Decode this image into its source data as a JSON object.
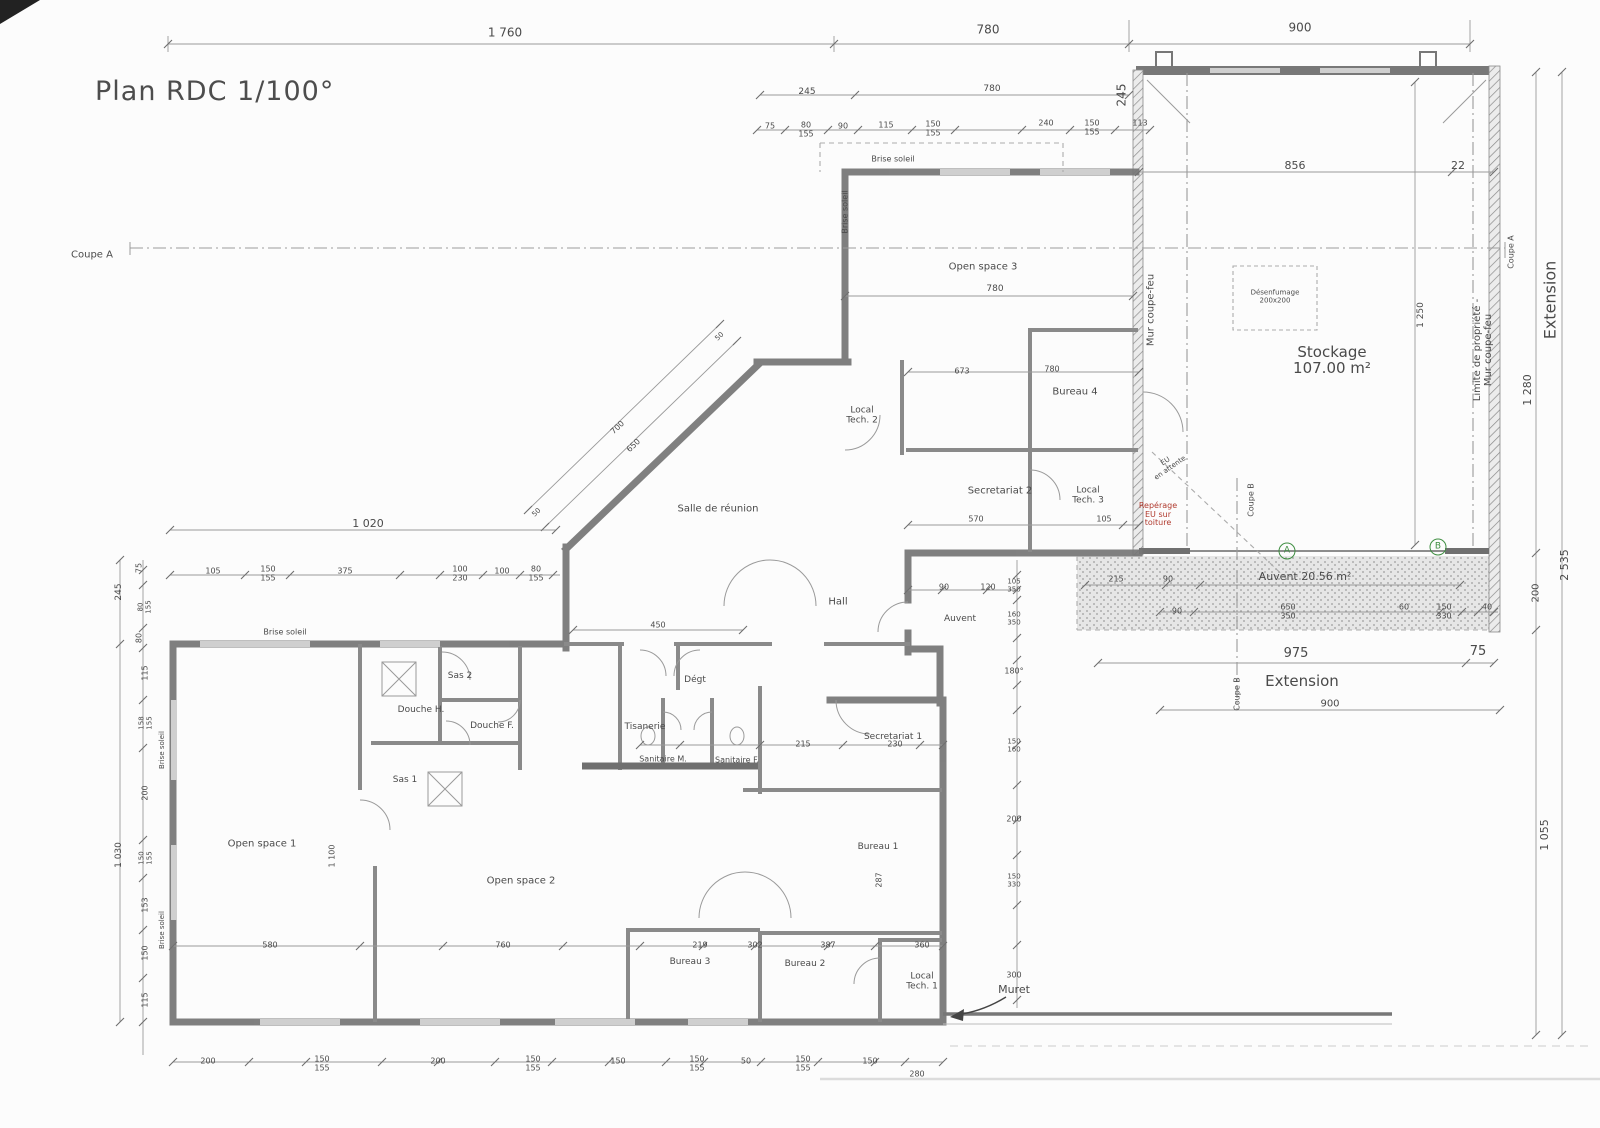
{
  "title": "Plan RDC 1/100°",
  "colors": {
    "annotation_red": "#b03a2e",
    "marker_green": "#3e8e41",
    "line_gray": "#9a9a9a",
    "wall_gray": "#757575"
  },
  "labels": [
    {
      "t": "Coupe A",
      "x": 92,
      "y": 256,
      "s": 10,
      "n": "section-a-label"
    },
    {
      "t": "1 760",
      "x": 505,
      "y": 33,
      "s": 12
    },
    {
      "t": "780",
      "x": 988,
      "y": 30,
      "s": 12
    },
    {
      "t": "900",
      "x": 1300,
      "y": 28,
      "s": 12
    },
    {
      "t": "245",
      "x": 807,
      "y": 93,
      "s": 9
    },
    {
      "t": "780",
      "x": 992,
      "y": 90,
      "s": 9
    },
    {
      "t": "245",
      "x": 1122,
      "y": 95,
      "s": 12,
      "r": -90
    },
    {
      "t": "75",
      "x": 770,
      "y": 127,
      "s": 8
    },
    {
      "t": "80\n155",
      "x": 806,
      "y": 130,
      "s": 8
    },
    {
      "t": "90",
      "x": 843,
      "y": 127,
      "s": 8
    },
    {
      "t": "115",
      "x": 886,
      "y": 126,
      "s": 8
    },
    {
      "t": "150\n155",
      "x": 933,
      "y": 129,
      "s": 8
    },
    {
      "t": "240",
      "x": 1046,
      "y": 124,
      "s": 8
    },
    {
      "t": "150\n155",
      "x": 1092,
      "y": 128,
      "s": 8
    },
    {
      "t": "113",
      "x": 1140,
      "y": 124,
      "s": 8
    },
    {
      "t": "Brise soleil",
      "x": 893,
      "y": 160,
      "s": 8,
      "n": "brise-soleil-label"
    },
    {
      "t": "Brise soleil",
      "x": 846,
      "y": 212,
      "s": 8,
      "r": -90,
      "n": "brise-soleil-label"
    },
    {
      "t": "856",
      "x": 1295,
      "y": 166,
      "s": 11
    },
    {
      "t": "22",
      "x": 1458,
      "y": 166,
      "s": 11
    },
    {
      "t": "Open space 3",
      "x": 983,
      "y": 268,
      "s": 10,
      "n": "room-label-open-space-3"
    },
    {
      "t": "780",
      "x": 995,
      "y": 290,
      "s": 9
    },
    {
      "t": "Bureau 4",
      "x": 1075,
      "y": 393,
      "s": 10,
      "n": "room-label-bureau-4"
    },
    {
      "t": "673",
      "x": 962,
      "y": 372,
      "s": 8
    },
    {
      "t": "780",
      "x": 1052,
      "y": 370,
      "s": 8
    },
    {
      "t": "Local\nTech. 2",
      "x": 862,
      "y": 416,
      "s": 9,
      "n": "room-label-local-tech-2"
    },
    {
      "t": "Secretariat 2",
      "x": 1000,
      "y": 492,
      "s": 10,
      "n": "room-label-secretariat-2"
    },
    {
      "t": "Local\nTech. 3",
      "x": 1088,
      "y": 496,
      "s": 9,
      "n": "room-label-local-tech-3"
    },
    {
      "t": "570",
      "x": 976,
      "y": 520,
      "s": 8
    },
    {
      "t": "105",
      "x": 1104,
      "y": 520,
      "s": 8
    },
    {
      "t": "Stockage\n107.00 m²",
      "x": 1332,
      "y": 360,
      "s": 15,
      "n": "room-label-stockage"
    },
    {
      "t": "Désenfumage\n200x200",
      "x": 1275,
      "y": 297,
      "s": 7,
      "n": "smoke-vent-label"
    },
    {
      "t": "1 250",
      "x": 1422,
      "y": 315,
      "s": 9,
      "r": -90
    },
    {
      "t": "Mur coupe-feu",
      "x": 1152,
      "y": 310,
      "s": 10,
      "r": -90,
      "n": "firewall-label"
    },
    {
      "t": "Limite de propriété - Mur coupe-feu",
      "x": 1484,
      "y": 350,
      "s": 10,
      "r": -90,
      "n": "property-limit-label"
    },
    {
      "t": "Coupe A",
      "x": 1512,
      "y": 252,
      "s": 8,
      "r": -90,
      "n": "section-a-label"
    },
    {
      "t": "Extension",
      "x": 1550,
      "y": 300,
      "s": 16,
      "r": -90,
      "n": "extension-label"
    },
    {
      "t": "1 280",
      "x": 1528,
      "y": 390,
      "s": 11,
      "r": -90
    },
    {
      "t": "2 535",
      "x": 1565,
      "y": 565,
      "s": 11,
      "r": -90
    },
    {
      "t": "200",
      "x": 1537,
      "y": 593,
      "s": 10,
      "r": -90
    },
    {
      "t": "1 055",
      "x": 1545,
      "y": 835,
      "s": 11,
      "r": -90
    },
    {
      "t": "EU\nen attente",
      "x": 1168,
      "y": 465,
      "s": 7,
      "r": -35,
      "n": "eu-attente-note"
    },
    {
      "t": "Repérage\nEU sur\ntoiture",
      "x": 1158,
      "y": 515,
      "s": 8,
      "c": "red",
      "n": "red-annotation"
    },
    {
      "t": "Coupe B",
      "x": 1252,
      "y": 500,
      "s": 8,
      "r": -90,
      "n": "section-b-label"
    },
    {
      "t": "Coupe B",
      "x": 1238,
      "y": 694,
      "s": 8,
      "r": -90,
      "n": "section-b-label"
    },
    {
      "t": "A",
      "x": 1287,
      "y": 551,
      "s": 9,
      "circle": true,
      "n": "marker-a"
    },
    {
      "t": "B",
      "x": 1438,
      "y": 547,
      "s": 9,
      "circle": true,
      "n": "marker-b"
    },
    {
      "t": "Auvent 20.56 m²",
      "x": 1305,
      "y": 577,
      "s": 11,
      "n": "room-label-auvent"
    },
    {
      "t": "215",
      "x": 1116,
      "y": 580,
      "s": 8
    },
    {
      "t": "90",
      "x": 1168,
      "y": 580,
      "s": 8
    },
    {
      "t": "90",
      "x": 1177,
      "y": 612,
      "s": 8
    },
    {
      "t": "650\n350",
      "x": 1288,
      "y": 612,
      "s": 8
    },
    {
      "t": "60",
      "x": 1404,
      "y": 608,
      "s": 8
    },
    {
      "t": "150\n330",
      "x": 1444,
      "y": 612,
      "s": 8
    },
    {
      "t": "40",
      "x": 1487,
      "y": 608,
      "s": 8
    },
    {
      "t": "975",
      "x": 1296,
      "y": 654,
      "s": 13
    },
    {
      "t": "75",
      "x": 1478,
      "y": 652,
      "s": 13
    },
    {
      "t": "Extension",
      "x": 1302,
      "y": 681,
      "s": 15,
      "n": "extension-label"
    },
    {
      "t": "900",
      "x": 1330,
      "y": 705,
      "s": 10
    },
    {
      "t": "Salle de réunion",
      "x": 718,
      "y": 510,
      "s": 10,
      "n": "room-label-salle-de-reunion"
    },
    {
      "t": "700",
      "x": 618,
      "y": 428,
      "s": 8,
      "r": -44
    },
    {
      "t": "650",
      "x": 634,
      "y": 446,
      "s": 8,
      "r": -44
    },
    {
      "t": "50",
      "x": 720,
      "y": 337,
      "s": 7,
      "r": -44
    },
    {
      "t": "50",
      "x": 537,
      "y": 513,
      "s": 7,
      "r": -44
    },
    {
      "t": "Hall",
      "x": 838,
      "y": 603,
      "s": 10,
      "n": "room-label-hall"
    },
    {
      "t": "450",
      "x": 658,
      "y": 626,
      "s": 8
    },
    {
      "t": "Auvent",
      "x": 960,
      "y": 620,
      "s": 9,
      "n": "room-label-auvent-entry"
    },
    {
      "t": "90",
      "x": 944,
      "y": 588,
      "s": 8
    },
    {
      "t": "120",
      "x": 988,
      "y": 588,
      "s": 8
    },
    {
      "t": "1 020",
      "x": 368,
      "y": 524,
      "s": 11
    },
    {
      "t": "105",
      "x": 213,
      "y": 572,
      "s": 8
    },
    {
      "t": "150\n155",
      "x": 268,
      "y": 574,
      "s": 8
    },
    {
      "t": "375",
      "x": 345,
      "y": 572,
      "s": 8
    },
    {
      "t": "100\n230",
      "x": 460,
      "y": 574,
      "s": 8
    },
    {
      "t": "100",
      "x": 502,
      "y": 572,
      "s": 8
    },
    {
      "t": "80\n155",
      "x": 536,
      "y": 574,
      "s": 8
    },
    {
      "t": "245",
      "x": 120,
      "y": 592,
      "s": 9,
      "r": -90
    },
    {
      "t": "75",
      "x": 140,
      "y": 568,
      "s": 8,
      "r": -90
    },
    {
      "t": "80\n155",
      "x": 145,
      "y": 607,
      "s": 7,
      "r": -90
    },
    {
      "t": "80",
      "x": 140,
      "y": 638,
      "s": 8,
      "r": -90
    },
    {
      "t": "Brise soleil",
      "x": 285,
      "y": 633,
      "s": 8,
      "n": "brise-soleil-label"
    },
    {
      "t": "115",
      "x": 146,
      "y": 673,
      "s": 8,
      "r": -90
    },
    {
      "t": "158\n155",
      "x": 146,
      "y": 723,
      "s": 7,
      "r": -90
    },
    {
      "t": "200",
      "x": 146,
      "y": 793,
      "s": 8,
      "r": -90
    },
    {
      "t": "150\n155",
      "x": 146,
      "y": 858,
      "s": 7,
      "r": -90
    },
    {
      "t": "153",
      "x": 146,
      "y": 905,
      "s": 8,
      "r": -90
    },
    {
      "t": "150",
      "x": 146,
      "y": 953,
      "s": 8,
      "r": -90
    },
    {
      "t": "115",
      "x": 146,
      "y": 1000,
      "s": 8,
      "r": -90
    },
    {
      "t": "1 030",
      "x": 120,
      "y": 855,
      "s": 9,
      "r": -90
    },
    {
      "t": "Brise soleil",
      "x": 163,
      "y": 750,
      "s": 7,
      "r": -90,
      "n": "brise-soleil-label"
    },
    {
      "t": "Brise soleil",
      "x": 163,
      "y": 930,
      "s": 7,
      "r": -90,
      "n": "brise-soleil-label"
    },
    {
      "t": "Open space 1",
      "x": 262,
      "y": 845,
      "s": 10,
      "n": "room-label-open-space-1"
    },
    {
      "t": "Open space 2",
      "x": 521,
      "y": 882,
      "s": 10,
      "n": "room-label-open-space-2"
    },
    {
      "t": "Sas 2",
      "x": 460,
      "y": 677,
      "s": 9,
      "n": "room-label-sas-2"
    },
    {
      "t": "Sas 1",
      "x": 405,
      "y": 781,
      "s": 9,
      "n": "room-label-sas-1"
    },
    {
      "t": "Douche H.",
      "x": 421,
      "y": 711,
      "s": 9,
      "n": "room-label-douche-h"
    },
    {
      "t": "Douche F.",
      "x": 492,
      "y": 727,
      "s": 9,
      "n": "room-label-douche-f"
    },
    {
      "t": "Tisanerie",
      "x": 645,
      "y": 728,
      "s": 9,
      "n": "room-label-tisanerie"
    },
    {
      "t": "Dégt",
      "x": 695,
      "y": 681,
      "s": 9,
      "n": "room-label-degagement"
    },
    {
      "t": "Sanitaire M.",
      "x": 663,
      "y": 760,
      "s": 8,
      "n": "room-label-sanitaire-m"
    },
    {
      "t": "Sanitaire F.",
      "x": 737,
      "y": 761,
      "s": 8,
      "n": "room-label-sanitaire-f"
    },
    {
      "t": "Secretariat 1",
      "x": 893,
      "y": 738,
      "s": 9,
      "n": "room-label-secretariat-1"
    },
    {
      "t": "Bureau 1",
      "x": 878,
      "y": 848,
      "s": 9,
      "n": "room-label-bureau-1"
    },
    {
      "t": "287",
      "x": 880,
      "y": 880,
      "s": 8,
      "r": -90
    },
    {
      "t": "Bureau 2",
      "x": 805,
      "y": 965,
      "s": 9,
      "n": "room-label-bureau-2"
    },
    {
      "t": "Bureau 3",
      "x": 690,
      "y": 963,
      "s": 9,
      "n": "room-label-bureau-3"
    },
    {
      "t": "Local\nTech. 1",
      "x": 922,
      "y": 982,
      "s": 9,
      "n": "room-label-local-tech-1"
    },
    {
      "t": "Muret",
      "x": 1014,
      "y": 990,
      "s": 11,
      "n": "muret-label"
    },
    {
      "t": "215",
      "x": 803,
      "y": 745,
      "s": 8
    },
    {
      "t": "230",
      "x": 895,
      "y": 745,
      "s": 8
    },
    {
      "t": "105\n350",
      "x": 1014,
      "y": 586,
      "s": 7
    },
    {
      "t": "160\n350",
      "x": 1014,
      "y": 619,
      "s": 7
    },
    {
      "t": "180°",
      "x": 1014,
      "y": 672,
      "s": 8
    },
    {
      "t": "150\n160",
      "x": 1014,
      "y": 746,
      "s": 7
    },
    {
      "t": "200",
      "x": 1014,
      "y": 820,
      "s": 8
    },
    {
      "t": "150\n330",
      "x": 1014,
      "y": 881,
      "s": 7
    },
    {
      "t": "300",
      "x": 1014,
      "y": 976,
      "s": 8
    },
    {
      "t": "200",
      "x": 208,
      "y": 1062,
      "s": 8
    },
    {
      "t": "150\n155",
      "x": 322,
      "y": 1064,
      "s": 8
    },
    {
      "t": "200",
      "x": 438,
      "y": 1062,
      "s": 8
    },
    {
      "t": "150\n155",
      "x": 533,
      "y": 1064,
      "s": 8
    },
    {
      "t": "150",
      "x": 618,
      "y": 1062,
      "s": 8
    },
    {
      "t": "150\n155",
      "x": 697,
      "y": 1064,
      "s": 8
    },
    {
      "t": "50",
      "x": 746,
      "y": 1062,
      "s": 8
    },
    {
      "t": "150\n155",
      "x": 803,
      "y": 1064,
      "s": 8
    },
    {
      "t": "150",
      "x": 870,
      "y": 1062,
      "s": 8
    },
    {
      "t": "280",
      "x": 917,
      "y": 1075,
      "s": 8
    },
    {
      "t": "580",
      "x": 270,
      "y": 946,
      "s": 8
    },
    {
      "t": "760",
      "x": 503,
      "y": 946,
      "s": 8
    },
    {
      "t": "219",
      "x": 700,
      "y": 946,
      "s": 8
    },
    {
      "t": "302",
      "x": 755,
      "y": 946,
      "s": 8
    },
    {
      "t": "387",
      "x": 828,
      "y": 946,
      "s": 8
    },
    {
      "t": "360",
      "x": 922,
      "y": 946,
      "s": 8
    },
    {
      "t": "1 100",
      "x": 333,
      "y": 856,
      "s": 8,
      "r": -90
    }
  ]
}
